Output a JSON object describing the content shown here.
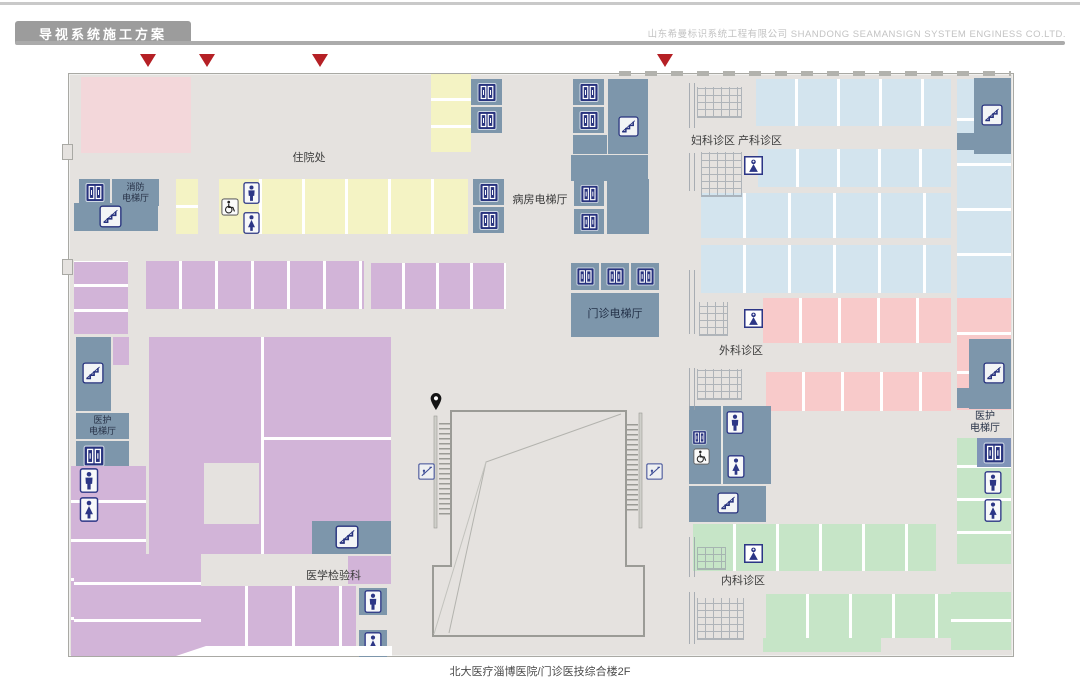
{
  "header": {
    "doc_title": "导视系统施工方案",
    "company": "山东希曼标识系统工程有限公司  SHANDONG SEAMANSIGN SYSTEM ENGINESS CO.LTD."
  },
  "floor_plan": {
    "caption": "北大医疗淄博医院/门诊医技综合楼2F",
    "areas": {
      "inpatient": "住院处",
      "ward_elevator_hall": "病房电梯厅",
      "outpatient_elevator_hall": "门诊电梯厅",
      "fire_elevator_hall": "消防\n电梯厅",
      "staff_elevator_hall_left": "医护\n电梯厅",
      "staff_elevator_hall_right": "医护\n电梯厅",
      "gyn_obstetrics": "妇科诊区 产科诊区",
      "surgery_clinic": "外科诊区",
      "internal_medicine_clinic": "内科诊区",
      "medical_lab": "医学检验科"
    },
    "colors": {
      "floor": "#e5e2df",
      "pink_block": "#f3d7da",
      "yellow_block": "#f4f3c4",
      "light_blue_block": "#d3e4ee",
      "purple_block": "#d2b4d8",
      "pink_clinic": "#f8caca",
      "green_clinic": "#c6e5c7",
      "hall_blue": "#7d96ab",
      "icon_navy": "#27327e",
      "marker_red": "#b52025"
    }
  }
}
